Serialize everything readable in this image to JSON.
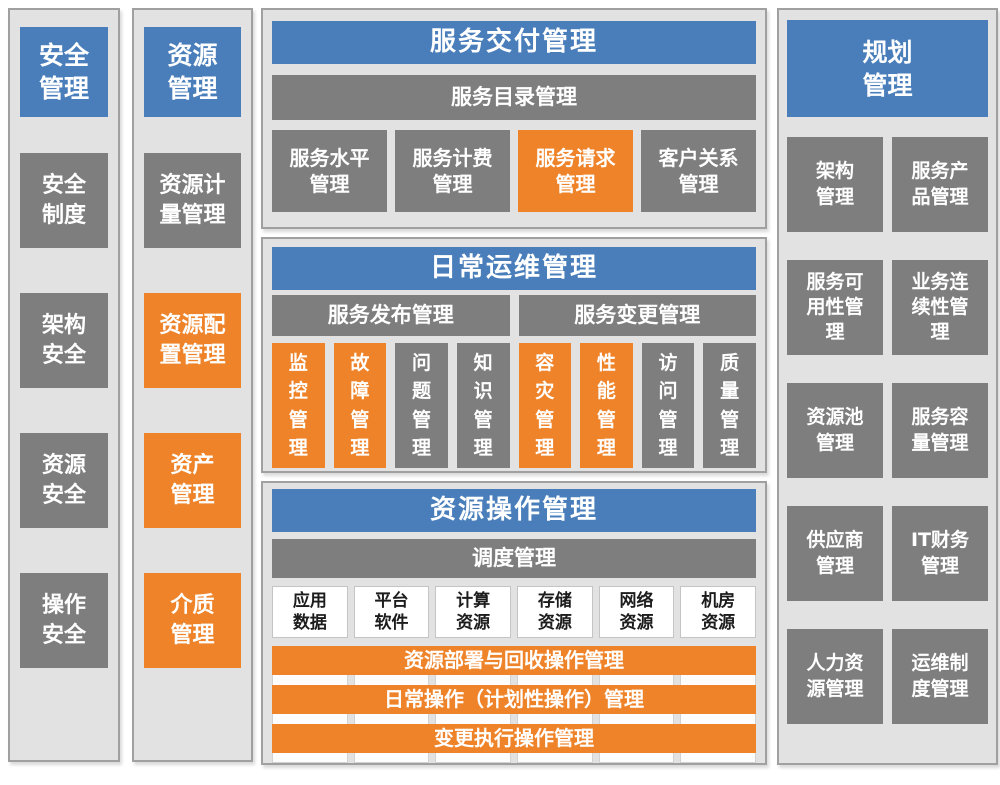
{
  "colors": {
    "header_blue": "#4a7ebb",
    "highlight_orange": "#ef8329",
    "block_gray": "#7e7e7e",
    "panel_background": "#e2e2e2",
    "panel_border": "#a0a0a0",
    "white_block_text": "#1c1c1c"
  },
  "security_column": {
    "header": "安全\n管理",
    "items": [
      {
        "label": "安全\n制度",
        "color": "gray"
      },
      {
        "label": "架构\n安全",
        "color": "gray"
      },
      {
        "label": "资源\n安全",
        "color": "gray"
      },
      {
        "label": "操作\n安全",
        "color": "gray"
      }
    ]
  },
  "resource_column": {
    "header": "资源\n管理",
    "items": [
      {
        "label": "资源计\n量管理",
        "color": "gray"
      },
      {
        "label": "资源配\n置管理",
        "color": "orange"
      },
      {
        "label": "资产\n管理",
        "color": "orange"
      },
      {
        "label": "介质\n管理",
        "color": "orange"
      }
    ]
  },
  "service_delivery": {
    "title": "服务交付管理",
    "catalog_bar": "服务目录管理",
    "items": [
      {
        "label": "服务水平\n管理",
        "color": "gray"
      },
      {
        "label": "服务计费\n管理",
        "color": "gray"
      },
      {
        "label": "服务请求\n管理",
        "color": "orange"
      },
      {
        "label": "客户关系\n管理",
        "color": "gray"
      }
    ]
  },
  "daily_operations": {
    "title": "日常运维管理",
    "release_bar": "服务发布管理",
    "change_bar": "服务变更管理",
    "items": [
      {
        "label": "监\n控\n管\n理",
        "color": "orange"
      },
      {
        "label": "故\n障\n管\n理",
        "color": "orange"
      },
      {
        "label": "问\n题\n管\n理",
        "color": "gray"
      },
      {
        "label": "知\n识\n管\n理",
        "color": "gray"
      },
      {
        "label": "容\n灾\n管\n理",
        "color": "orange"
      },
      {
        "label": "性\n能\n管\n理",
        "color": "orange"
      },
      {
        "label": "访\n问\n管\n理",
        "color": "gray"
      },
      {
        "label": "质\n量\n管\n理",
        "color": "gray"
      }
    ]
  },
  "resource_operations": {
    "title": "资源操作管理",
    "dispatch_bar": "调度管理",
    "resources": [
      {
        "label": "应用\n数据"
      },
      {
        "label": "平台\n软件"
      },
      {
        "label": "计算\n资源"
      },
      {
        "label": "存储\n资源"
      },
      {
        "label": "网络\n资源"
      },
      {
        "label": "机房\n资源"
      }
    ],
    "bars": [
      {
        "label": "资源部署与回收操作管理"
      },
      {
        "label": "日常操作（计划性操作）管理"
      },
      {
        "label": "变更执行操作管理"
      }
    ]
  },
  "planning_column": {
    "header": "规划\n管理",
    "items": [
      {
        "label": "架构\n管理"
      },
      {
        "label": "服务产\n品管理"
      },
      {
        "label": "服务可\n用性管\n理"
      },
      {
        "label": "业务连\n续性管\n理"
      },
      {
        "label": "资源池\n管理"
      },
      {
        "label": "服务容\n量管理"
      },
      {
        "label": "供应商\n管理"
      },
      {
        "label": "IT财务\n管理"
      },
      {
        "label": "人力资\n源管理"
      },
      {
        "label": "运维制\n度管理"
      }
    ]
  }
}
